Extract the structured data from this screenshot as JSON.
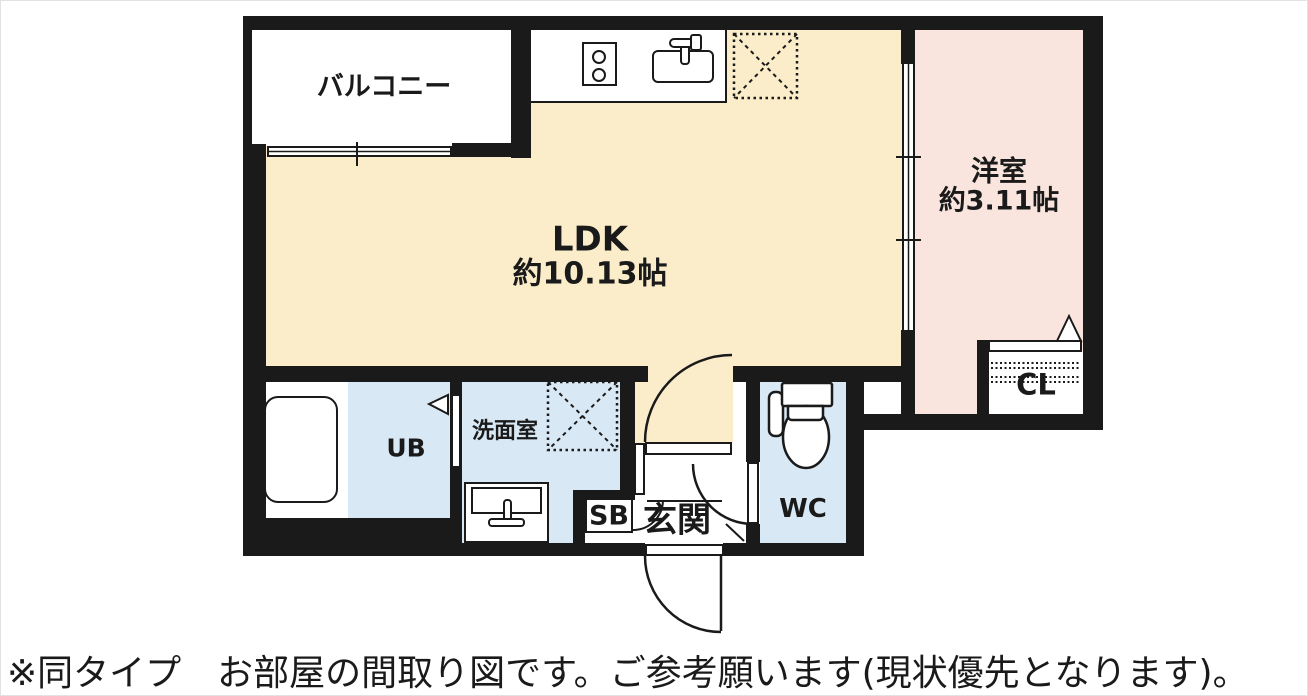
{
  "colors": {
    "wall": "#1a1a1a",
    "ldk_floor": "#fbedca",
    "western_floor": "#f9e5de",
    "wet_floor": "#d9e8f5",
    "text": "#1a1a1a"
  },
  "rooms": {
    "balcony": {
      "label": "バルコニー"
    },
    "ldk": {
      "label": "LDK",
      "size": "約10.13帖"
    },
    "western": {
      "label": "洋室",
      "size": "約3.11帖"
    },
    "washroom": {
      "label": "洗面室"
    },
    "bath": {
      "label": "UB"
    },
    "toilet": {
      "label": "WC"
    },
    "entrance": {
      "label": "玄関"
    },
    "shoebox": {
      "label": "SB"
    },
    "closet": {
      "label": "CL"
    }
  },
  "caption": "※同タイプ　お部屋の間取り図です。ご参考願います(現状優先となります)。"
}
